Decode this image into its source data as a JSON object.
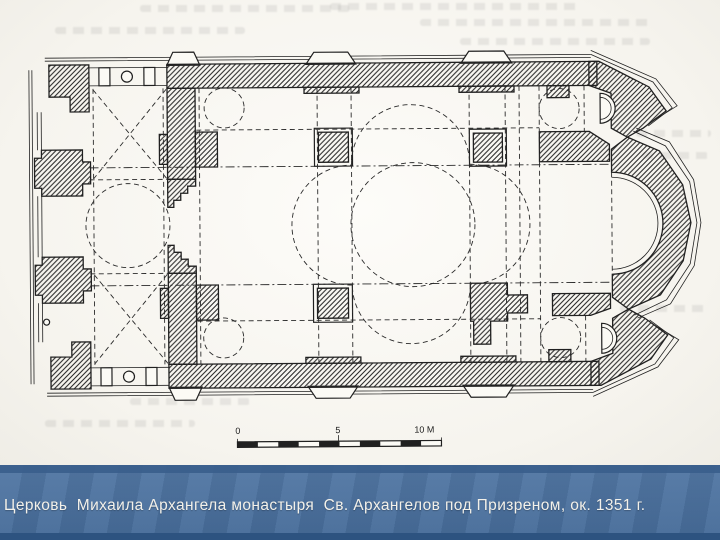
{
  "slide": {
    "caption": {
      "text": "Церковь  Михаила Архангела монастыря  Св. Архангелов под Призреном, ок. 1351 г.",
      "bar_color": "#49709f",
      "bar_top_color": "#3a5e8c",
      "bar_bottom_color": "#2d5380",
      "text_color": "#f3f1ea"
    },
    "drawing": {
      "subject": "church floor plan: narthex, domed naos on four piers, triple-apse polygonal east end",
      "ink_color": "#202020",
      "paper_color": "#f8f6f1",
      "scale_bar": {
        "label_start": "0",
        "label_mid": "5",
        "label_end": "10 M"
      }
    }
  }
}
